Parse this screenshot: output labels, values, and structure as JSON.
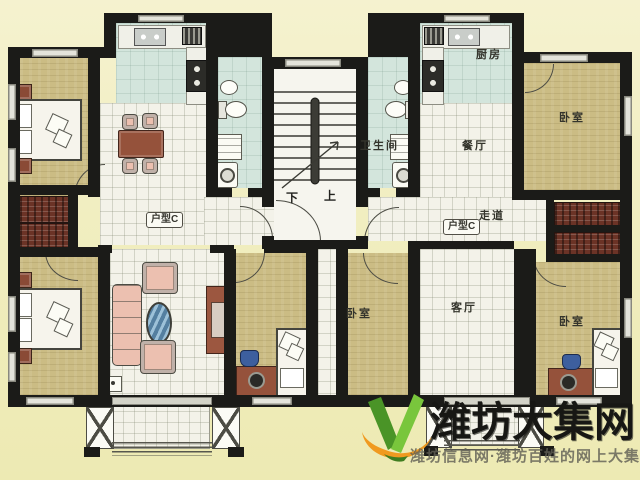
{
  "floor_plan": {
    "left_unit": {
      "type_badge": "户型C"
    },
    "right_unit": {
      "type_badge": "户型C",
      "rooms": {
        "kitchen": "厨房",
        "bathroom": "卫生间",
        "dining": "餐厅",
        "corridor": "走道",
        "living_room": "客厅",
        "bedroom_top_right": "卧室",
        "bedroom_bottom_left": "卧室",
        "bedroom_bottom_right": "卧室"
      }
    },
    "staircase": {
      "down_label": "下",
      "up_label": "上"
    }
  },
  "watermark": {
    "site_name": "潍坊大集网",
    "tagline": "潍坊信息网·潍坊百姓的网上大集"
  },
  "colors": {
    "background": "#f0edbd",
    "wall": "#1b1b18",
    "bedroom_floor": "#cbbc84",
    "wet_room_floor": "#d3e5dc",
    "tile_floor": "#f3f2e9",
    "wood_furniture": "#95523b",
    "wardrobe": "#6b3326",
    "upholstery": "#ecc0b0",
    "coffee_table": "#547fa0",
    "logo_green_dark": "#4a9427",
    "logo_green_light": "#79c63c",
    "logo_orange": "#f09a20",
    "watermark_text": "#171714",
    "tagline_text": "#626056"
  }
}
